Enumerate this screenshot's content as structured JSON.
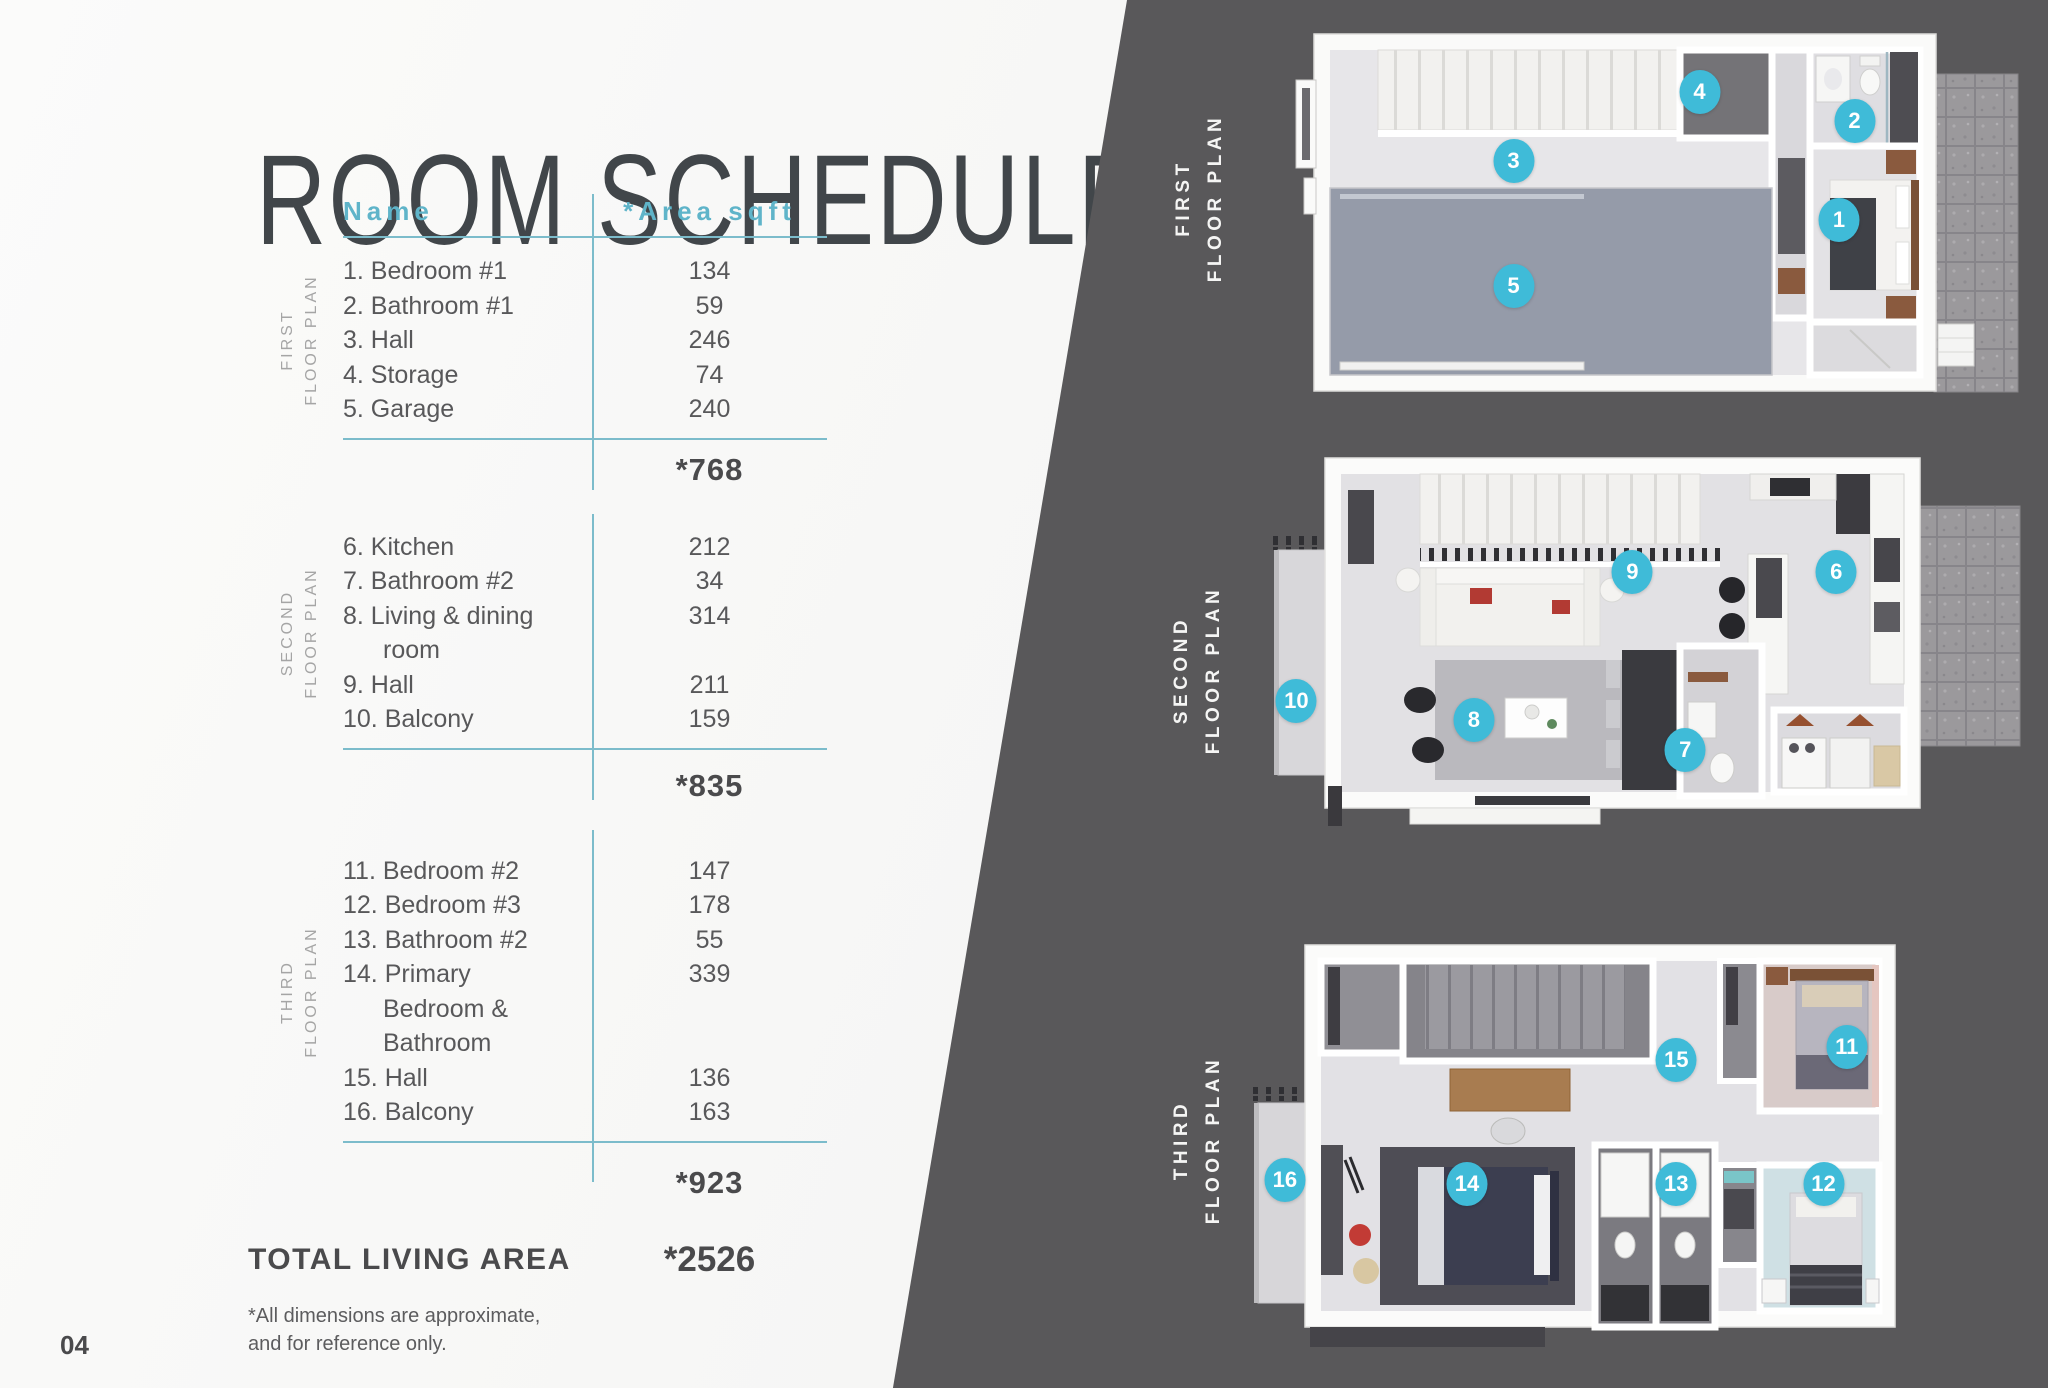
{
  "colors": {
    "accent_teal": "#5FB4C9",
    "line_teal": "#7CBCCB",
    "marker_cyan": "#3FBBD8",
    "panel_dark": "#59585A",
    "text_dark": "#4F4F51",
    "label_gray": "#A5A5A5",
    "title_gray": "#41464A"
  },
  "page": {
    "title": "ROOM SCHEDULE",
    "page_number": "04",
    "footnote": "*All dimensions are approximate,\nand for reference only.",
    "total_label": "TOTAL LIVING AREA",
    "total_value": "*2526"
  },
  "table": {
    "headers": {
      "name": "Name",
      "area": "*Area sqft"
    },
    "sections": [
      {
        "label": "FIRST\nFLOOR PLAN",
        "rows": [
          {
            "name_lines": [
              "1. Bedroom #1"
            ],
            "area": "134"
          },
          {
            "name_lines": [
              "2. Bathroom #1"
            ],
            "area": "59"
          },
          {
            "name_lines": [
              "3. Hall"
            ],
            "area": "246"
          },
          {
            "name_lines": [
              "4. Storage"
            ],
            "area": "74"
          },
          {
            "name_lines": [
              "5. Garage"
            ],
            "area": "240"
          }
        ],
        "subtotal": "*768"
      },
      {
        "label": "SECOND\nFLOOR PLAN",
        "rows": [
          {
            "name_lines": [
              "6. Kitchen"
            ],
            "area": "212"
          },
          {
            "name_lines": [
              "7. Bathroom #2"
            ],
            "area": "34"
          },
          {
            "name_lines": [
              "8. Living & dining",
              "room"
            ],
            "area": "314"
          },
          {
            "name_lines": [
              "9. Hall"
            ],
            "area": "211"
          },
          {
            "name_lines": [
              "10. Balcony"
            ],
            "area": "159"
          }
        ],
        "subtotal": "*835"
      },
      {
        "label": "THIRD\nFLOOR PLAN",
        "rows": [
          {
            "name_lines": [
              "11. Bedroom #2"
            ],
            "area": "147"
          },
          {
            "name_lines": [
              "12. Bedroom #3"
            ],
            "area": "178"
          },
          {
            "name_lines": [
              "13. Bathroom #2"
            ],
            "area": "55"
          },
          {
            "name_lines": [
              "14. Primary",
              "Bedroom &",
              "Bathroom"
            ],
            "area": "339"
          },
          {
            "name_lines": [
              "15. Hall"
            ],
            "area": "136"
          },
          {
            "name_lines": [
              "16. Balcony"
            ],
            "area": "163"
          }
        ],
        "subtotal": "*923"
      }
    ]
  },
  "plans": [
    {
      "label": "FIRST\nFLOOR PLAN",
      "markers": [
        {
          "n": "1",
          "x": 76,
          "y": 52
        },
        {
          "n": "2",
          "x": 78,
          "y": 25
        },
        {
          "n": "3",
          "x": 34,
          "y": 36
        },
        {
          "n": "4",
          "x": 58,
          "y": 17
        },
        {
          "n": "5",
          "x": 34,
          "y": 70
        }
      ]
    },
    {
      "label": "SECOND\nFLOOR PLAN",
      "markers": [
        {
          "n": "6",
          "x": 75,
          "y": 32
        },
        {
          "n": "7",
          "x": 55,
          "y": 79
        },
        {
          "n": "8",
          "x": 27,
          "y": 71
        },
        {
          "n": "9",
          "x": 48,
          "y": 32
        },
        {
          "n": "10",
          "x": 3.5,
          "y": 66
        }
      ]
    },
    {
      "label": "THIRD\nFLOOR PLAN",
      "markers": [
        {
          "n": "11",
          "x": 77,
          "y": 27
        },
        {
          "n": "12",
          "x": 74,
          "y": 60
        },
        {
          "n": "13",
          "x": 55,
          "y": 60
        },
        {
          "n": "14",
          "x": 28,
          "y": 60
        },
        {
          "n": "15",
          "x": 55,
          "y": 30
        },
        {
          "n": "16",
          "x": 4.5,
          "y": 59
        }
      ]
    }
  ]
}
